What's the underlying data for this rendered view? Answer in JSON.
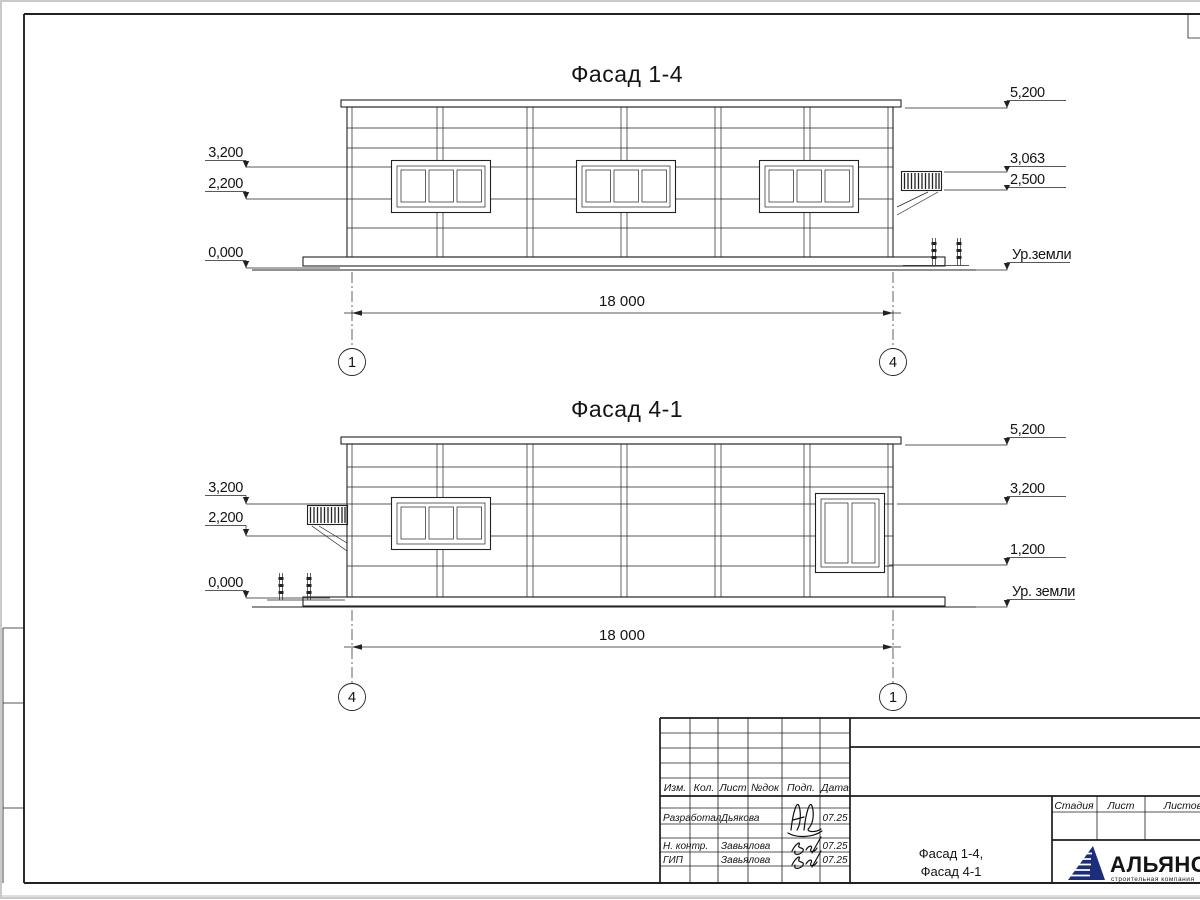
{
  "facades": [
    {
      "title": "Фасад 1-4",
      "left_marks": [
        "3,200",
        "2,200",
        "0,000"
      ],
      "right_marks": [
        "5,200",
        "3,063",
        "2,500"
      ],
      "ground_label": "Ур.земли",
      "dimension": "18 000",
      "axis_left": "1",
      "axis_right": "4"
    },
    {
      "title": "Фасад 4-1",
      "left_marks": [
        "3,200",
        "2,200",
        "0,000"
      ],
      "right_marks": [
        "5,200",
        "3,200",
        "1,200"
      ],
      "ground_label": "Ур. земли",
      "dimension": "18 000",
      "axis_left": "4",
      "axis_right": "1"
    }
  ],
  "title_block": {
    "revision_header": [
      "Изм.",
      "Кол.",
      "Лист",
      "№док",
      "Подп.",
      "Дата"
    ],
    "signature_rows": [
      {
        "role": "Разработал",
        "name": "Дьякова",
        "date": "07.25"
      },
      {
        "role": "Н. контр.",
        "name": "Завьялова",
        "date": "07.25"
      },
      {
        "role": "ГИП",
        "name": "Завьялова",
        "date": "07.25"
      }
    ],
    "doc_title_lines": [
      "Фасад 1-4,",
      "Фасад 4-1"
    ],
    "stage_header": [
      "Стадия",
      "Лист",
      "Листов"
    ],
    "logo_name": "АЛЬЯНС",
    "logo_subtitle": "строительная компания"
  },
  "colors": {
    "line": "#1f1f1f",
    "logo_navy": "#1c2e7b",
    "logo_blue": "#3a6fb0"
  }
}
